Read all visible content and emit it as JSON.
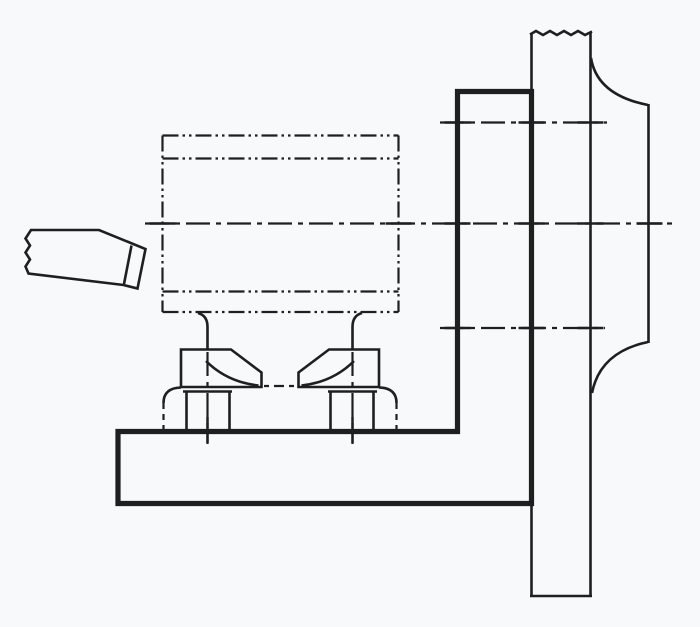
{
  "figure": {
    "type": "technical-line-drawing",
    "description": "Workpiece clamped to an angle plate mounted on a lathe faceplate, with a single-point cutting tool at left",
    "background": "#f7f9fa",
    "ink": "#1f1f1f",
    "canvas": {
      "width": 700,
      "height": 627
    }
  },
  "styles": {
    "object": {
      "width": 2.6,
      "dash": ""
    },
    "thick": {
      "width": 5.2,
      "dash": ""
    },
    "phantom": {
      "width": 2.2,
      "dash": "16 4 2.5 4 2.5 4"
    },
    "chain": {
      "width": 2.2,
      "dash": "24 6 5 6"
    },
    "chain-short": {
      "width": 2.2,
      "dash": "5 5 10 5"
    },
    "hidden-short": {
      "width": 2.2,
      "dash": "6 5"
    },
    "tick": {
      "width": 2.5,
      "dash": ""
    }
  },
  "parts": [
    {
      "name": "faceplate-left-face",
      "style": "object",
      "d": "M531.5,33 L531.5,596"
    },
    {
      "name": "faceplate-right-face",
      "style": "object",
      "d": "M590.5,33 L590.5,596"
    },
    {
      "name": "faceplate-bottom-edge",
      "style": "object",
      "d": "M530,596 L592,596"
    },
    {
      "name": "faceplate-top-break-line",
      "style": "object",
      "d": "M530,34.5 l6,-3.5 l7,4 l7,-4 l7,4 l7,-4 l7,4 l7,-4 l7,4 l7,-3.5"
    },
    {
      "name": "faceplate-hub-top-fillet",
      "style": "object",
      "d": "M591,58 Q597,95 648,105"
    },
    {
      "name": "faceplate-hub-edge",
      "style": "object",
      "d": "M648.5,104 L648.5,343"
    },
    {
      "name": "faceplate-hub-bottom-fillet",
      "style": "object",
      "d": "M648,342 Q600,352 592,393"
    },
    {
      "name": "angle-plate-outline",
      "style": "thick",
      "d": "M457.5,91.5 L531.5,91.5 L531.5,503.5 L118,503.5 L118,431.5 L457.5,431.5 Z"
    },
    {
      "name": "workpiece-top-edge",
      "style": "phantom",
      "d": "M162.5,135.5 L398.5,135.5"
    },
    {
      "name": "workpiece-step-upper",
      "style": "phantom",
      "d": "M162.5,158.5 L398.5,158.5"
    },
    {
      "name": "workpiece-step-lower",
      "style": "phantom",
      "d": "M162.5,291.5 L398.5,291.5"
    },
    {
      "name": "workpiece-bottom-edge",
      "style": "phantom",
      "d": "M162.5,312 L398.5,312"
    },
    {
      "name": "workpiece-left-edge",
      "style": "phantom",
      "d": "M162.5,135.5 L162.5,312"
    },
    {
      "name": "workpiece-right-edge",
      "style": "phantom",
      "d": "M398.5,135.5 L398.5,312"
    },
    {
      "name": "lathe-axis-centerline",
      "style": "chain",
      "d": "M145,223.5 L672,223.5"
    },
    {
      "name": "upper-bolt-centerline",
      "style": "chain",
      "d": "M440,122.5 L607,122.5"
    },
    {
      "name": "lower-bolt-centerline",
      "style": "chain",
      "d": "M440,328 L605,328"
    },
    {
      "name": "left-clamp-bolt-centerline",
      "style": "chain",
      "d": "M207.5,352 L207.5,444"
    },
    {
      "name": "right-clamp-bolt-centerline",
      "style": "chain",
      "d": "M352.5,352 L352.5,444"
    },
    {
      "name": "boss-centerline",
      "style": "chain-short",
      "d": "M264,386 L297,386"
    },
    {
      "name": "left-stud",
      "style": "object",
      "d": "M198,313 Q207.5,315.5 207.5,327 L207.5,350"
    },
    {
      "name": "right-stud",
      "style": "object",
      "d": "M362,313 Q352.5,315.5 352.5,327 L352.5,350"
    },
    {
      "name": "left-clamp-outline",
      "style": "object",
      "d": "M181,387 L181,349.5 L231,349.5 L261.5,372.5 L261.5,387 Z"
    },
    {
      "name": "left-clamp-nose-curve",
      "style": "object",
      "d": "M206,361 Q227,382 258.5,385.5"
    },
    {
      "name": "left-clamp-washer-edge",
      "style": "object",
      "d": "M183,391.5 L232,391.5"
    },
    {
      "name": "left-clamp-nut-left-edge",
      "style": "object",
      "d": "M186.5,391.5 L186.5,429.5"
    },
    {
      "name": "left-clamp-nut-right-edge",
      "style": "object",
      "d": "M229.5,391.5 L229.5,429.5"
    },
    {
      "name": "left-support-arc",
      "style": "object",
      "d": "M181,387.5 Q163.5,388 163.5,403"
    },
    {
      "name": "left-support-edge",
      "style": "hidden-short",
      "d": "M163.5,403 L163.5,429.5"
    },
    {
      "name": "right-clamp-outline",
      "style": "object",
      "d": "M379,387 L379,349.5 L329,349.5 L298.5,372.5 L298.5,387 Z"
    },
    {
      "name": "right-clamp-nose-curve",
      "style": "object",
      "d": "M354,361 Q333,382 301.5,385.5"
    },
    {
      "name": "right-clamp-washer-edge",
      "style": "object",
      "d": "M328,391.5 L377,391.5"
    },
    {
      "name": "right-clamp-nut-left-edge",
      "style": "object",
      "d": "M330.5,391.5 L330.5,429.5"
    },
    {
      "name": "right-clamp-nut-right-edge",
      "style": "object",
      "d": "M373.5,391.5 L373.5,429.5"
    },
    {
      "name": "right-support-arc",
      "style": "object",
      "d": "M379,387.5 Q396.5,388 396.5,403"
    },
    {
      "name": "right-support-edge",
      "style": "hidden-short",
      "d": "M396.5,403 L396.5,429.5"
    },
    {
      "name": "cutting-tool-outline",
      "style": "object",
      "d": "M28.5,273.5 L25.5,266.5 L30,259.5 L25.5,252.5 L30,245.5 L25.5,238.5 L31,230 L99,230 L145.5,249 L137.5,288.5 L123.5,285 Z"
    },
    {
      "name": "cutting-tool-tip-line",
      "style": "object",
      "d": "M131.5,245.5 L124,284"
    },
    {
      "name": "centerline-crossing-ticks",
      "style": "tick",
      "d": "M444.5,122.5 L470.5,122.5 M518.5,122.5 L544.5,122.5 M577.5,122.5 L603.5,122.5 M149.5,223.5 L175.5,223.5 M385.5,223.5 L411.5,223.5 M444.5,223.5 L470.5,223.5 M518.5,223.5 L544.5,223.5 M577.5,223.5 L603.5,223.5 M636.5,223.5 L662.5,223.5 M444.5,328 L470.5,328 M518.5,328 L544.5,328 M577.5,328 L603.5,328 M207.5,417 L207.5,443 M352.5,417 L352.5,443"
    }
  ]
}
